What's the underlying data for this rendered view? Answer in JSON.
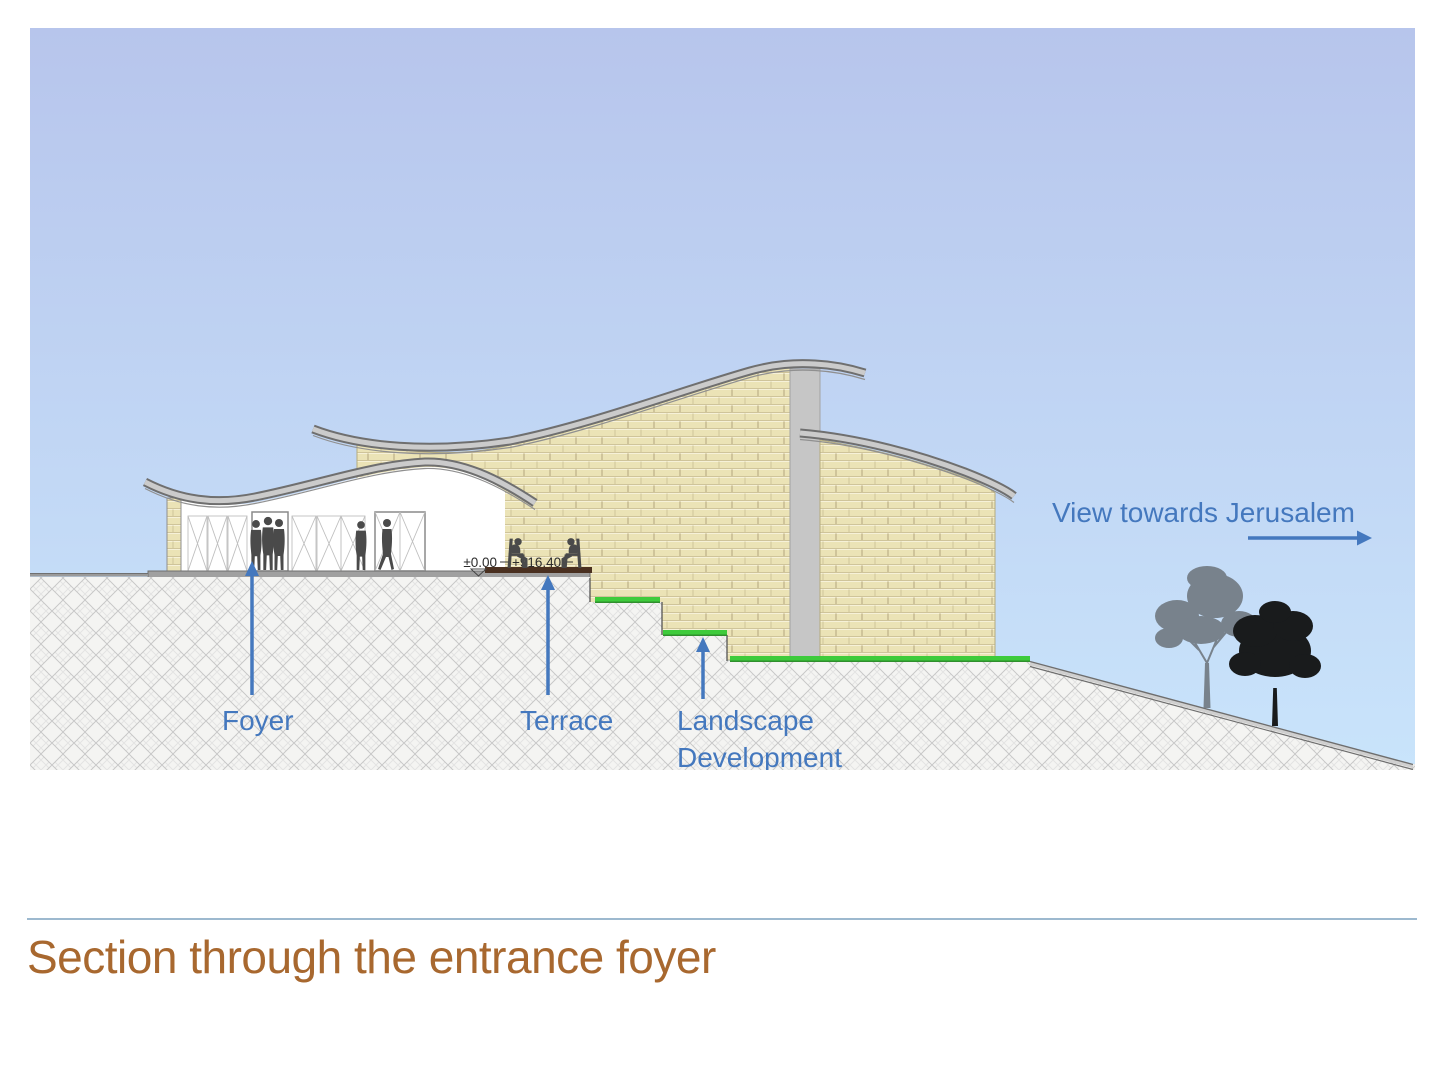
{
  "slide": {
    "title": "Section through the entrance foyer",
    "title_color": "#a8682f",
    "rule_color": "#9db9cf"
  },
  "drawing": {
    "colors": {
      "sky_top": "#b7c5ec",
      "sky_bottom": "#c9e4fb",
      "brick": "#ebe3b6",
      "brick_mortar": "#cfc49a",
      "hatch_bg": "#f4f4f2",
      "hatch_line": "#c6c6c6",
      "grass_green": "#3ecb3b",
      "grass_green_dark": "#2f8f2c",
      "roof_light": "#cbcbcb",
      "roof_dark": "#6f6f6f",
      "column_gray": "#c6c6c6",
      "slab_gray": "#a0a0a0",
      "terrace_brown": "#4a3020",
      "silhouette": "#4a4a4a",
      "tree_gray": "#78828c",
      "tree_black": "#191b1c",
      "annotation_blue": "#4478be",
      "elevation_text": "#2b2b2b"
    },
    "labels": {
      "foyer": "Foyer",
      "terrace": "Terrace",
      "landscape_line1": "Landscape",
      "landscape_line2": "Development",
      "view_direction": "View towards Jerusalem"
    },
    "elevations": {
      "datum": "±0.00",
      "terrace_level": "+916.40"
    }
  }
}
